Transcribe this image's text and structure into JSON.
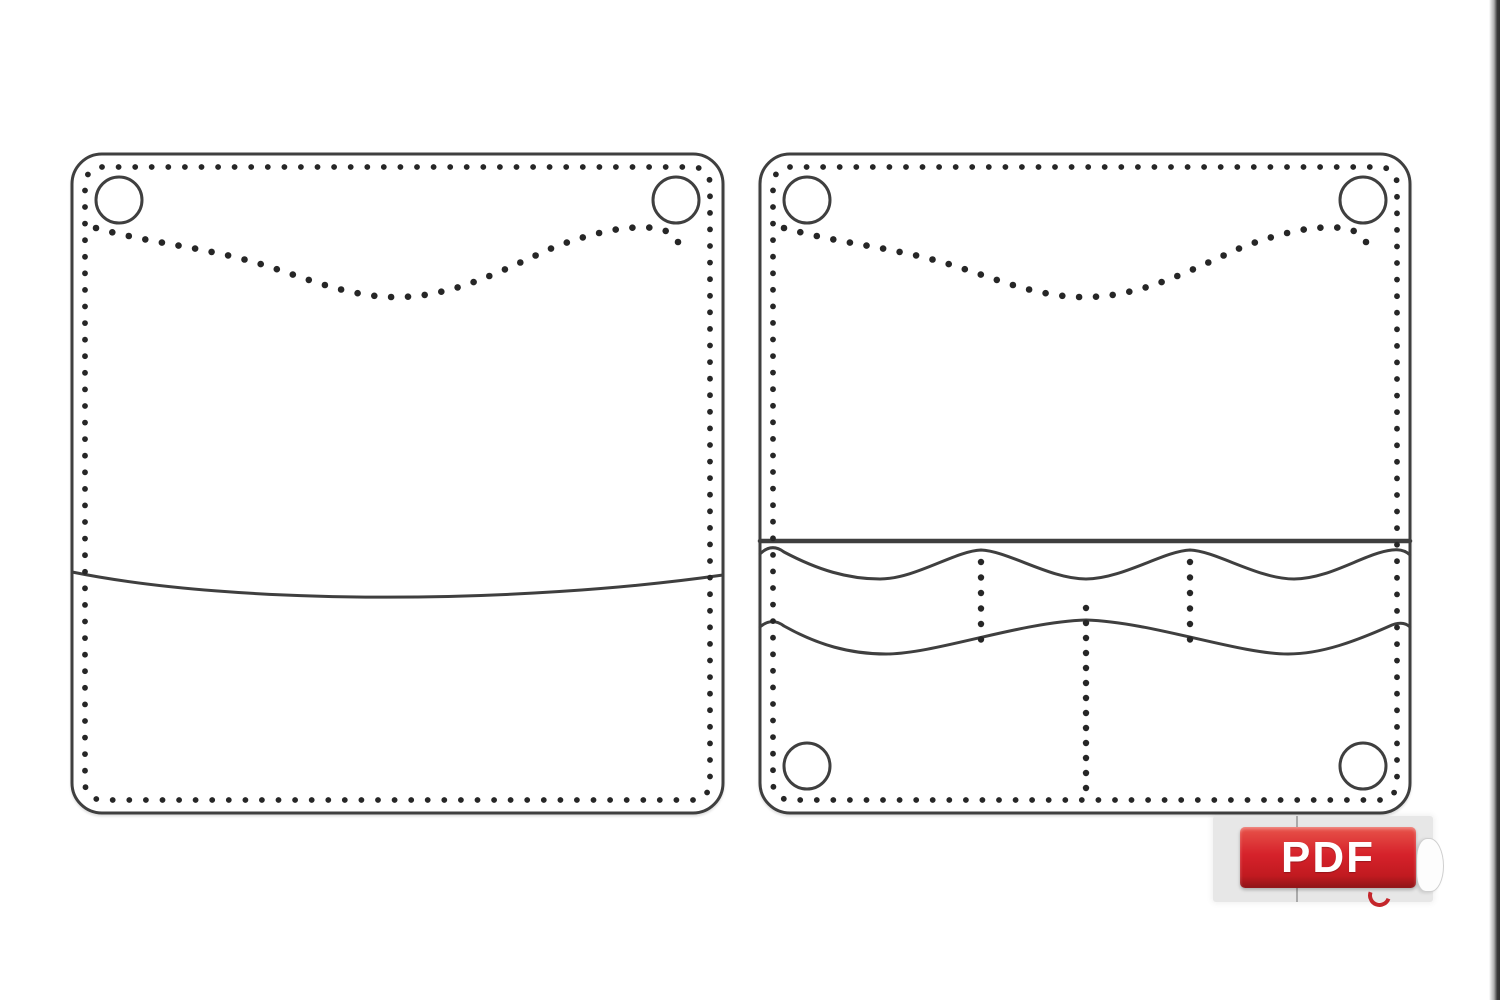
{
  "canvas": {
    "width": 1500,
    "height": 1000,
    "background": "#ffffff"
  },
  "style": {
    "outline_color": "#3f3f3f",
    "stitch_dot_color": "#262626",
    "panel_fill": "#ffffff"
  },
  "pattern": {
    "description": "leather bifold wallet sewing pattern, two panels with stitch holes",
    "panels": [
      {
        "name": "wallet-exterior-panel",
        "x": 72,
        "y": 154,
        "width": 651,
        "height": 659,
        "corner_radius": 30,
        "outline_width": 3,
        "stitch_inset": 13,
        "stitch_spacing": 16.6,
        "stitch_dot_radius": 2.9,
        "grommet_radius": 23,
        "grommet_stroke": 3,
        "grommets": [
          {
            "cx": 119,
            "cy": 200
          },
          {
            "cx": 676,
            "cy": 200
          }
        ],
        "dotted_curves": [
          {
            "d": "M 96 228 C 150 243 200 247 250 261 C 300 275 340 295 390 297 C 450 299 500 271 550 249 C 590 233 625 225 655 228 C 668 230 674 235 678 242",
            "spacing": 17,
            "dot_radius": 3.3
          }
        ],
        "solid_curves": [
          {
            "d": "M 72 572 C 240 606 520 604 723 575",
            "width": 3
          }
        ],
        "dotted_verticals": []
      },
      {
        "name": "wallet-interior-pocket-panel",
        "x": 760,
        "y": 154,
        "width": 650,
        "height": 659,
        "corner_radius": 30,
        "outline_width": 3,
        "stitch_inset": 13,
        "stitch_spacing": 16.6,
        "stitch_dot_radius": 2.9,
        "grommet_radius": 23,
        "grommet_stroke": 3,
        "grommets": [
          {
            "cx": 807,
            "cy": 200
          },
          {
            "cx": 1363,
            "cy": 200
          },
          {
            "cx": 807,
            "cy": 766
          },
          {
            "cx": 1363,
            "cy": 766
          }
        ],
        "dotted_curves": [
          {
            "d": "M 784 228 C 838 243 888 247 938 261 C 988 275 1028 295 1078 297 C 1138 299 1188 271 1238 249 C 1278 233 1313 225 1343 228 C 1356 230 1362 235 1366 242",
            "spacing": 17,
            "dot_radius": 3.3
          }
        ],
        "solid_curves": [
          {
            "d": "M 760 541 L 1410 541",
            "width": 4.5
          },
          {
            "d": "M 760 554 C 768 546 776 546 784 552 C 818 570 848 579 880 579 C 915 579 955 551 981 550 C 1008 551 1050 579 1086 579 C 1122 579 1164 551 1190 550 C 1216 551 1258 579 1294 579 C 1330 579 1365 553 1392 550 C 1400 549 1406 551 1410 555",
            "width": 3
          },
          {
            "d": "M 760 627 C 768 620 776 620 784 626 C 818 645 850 654 886 654 C 935 654 1020 622 1086 620 C 1152 622 1238 654 1288 654 C 1322 654 1356 641 1392 625 C 1400 622 1406 623 1410 627",
            "width": 3
          }
        ],
        "dotted_verticals": [
          {
            "x": 981,
            "y1": 562,
            "y2": 640,
            "spacing": 15.5,
            "dot_radius": 3.2
          },
          {
            "x": 1190,
            "y1": 562,
            "y2": 640,
            "spacing": 15.5,
            "dot_radius": 3.2
          },
          {
            "x": 1086,
            "y1": 608,
            "y2": 788,
            "spacing": 15,
            "dot_radius": 3.2
          }
        ]
      }
    ]
  },
  "pdf_badge": {
    "label": "PDF",
    "text_color": "#ffffff",
    "red_top": "#e8544a",
    "red_main": "#d6222b",
    "red_deep": "#c11a20",
    "red_dark": "#8e1417",
    "backdrop_color": "#e7e7e7",
    "divider_color": "#9b9b9b",
    "curl_color": "#c4262b"
  },
  "edge_bar": {
    "color_mid": "#b0b0b0",
    "color_dark": "#3a3a3a",
    "color_edge": "#303030"
  }
}
